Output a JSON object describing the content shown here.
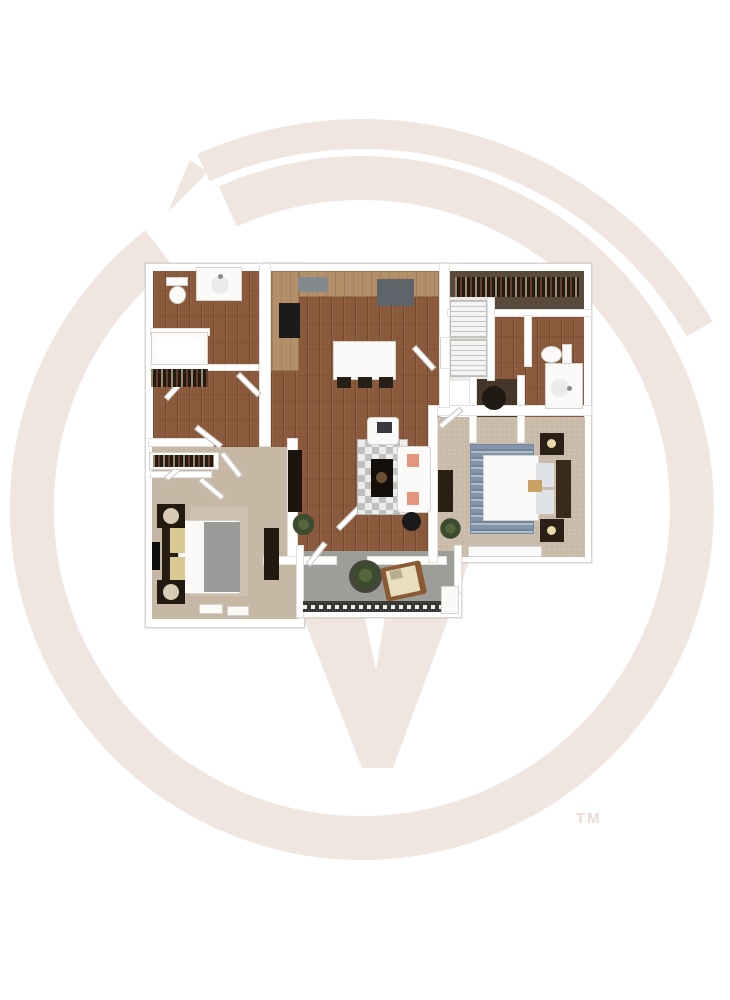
{
  "watermark": {
    "symbol": "V",
    "trademark_label": "TM",
    "color": "#f1e6df"
  },
  "plan": {
    "wall_color": "#ffffff",
    "wood_color": "#8b5a3c",
    "carpet_color": "#c9baa9",
    "patio_color": "#9d9d99",
    "rooms": [
      "bathroom-1",
      "hallway",
      "bedroom-left",
      "closet-left",
      "kitchen",
      "living-room",
      "walk-in-closet",
      "laundry-closet",
      "bathroom-2",
      "bedroom-right",
      "patio"
    ],
    "elements": [
      {
        "n": "slab-left-wing",
        "cls": "slab",
        "x": 145,
        "y": 263,
        "w": 160,
        "h": 365
      },
      {
        "n": "slab-center",
        "cls": "slab",
        "x": 263,
        "y": 263,
        "w": 184,
        "h": 302
      },
      {
        "n": "slab-right-wing",
        "cls": "slab",
        "x": 440,
        "y": 263,
        "w": 152,
        "h": 300
      },
      {
        "n": "slab-patio",
        "cls": "slab",
        "x": 296,
        "y": 545,
        "w": 166,
        "h": 73
      },
      {
        "n": "floor-bathroom1-hall",
        "cls": "wood",
        "x": 153,
        "y": 271,
        "w": 106,
        "h": 176
      },
      {
        "n": "floor-kitchen-living",
        "cls": "wood",
        "x": 271,
        "y": 271,
        "w": 168,
        "h": 287
      },
      {
        "n": "floor-walkin-closet",
        "x": 449,
        "y": 271,
        "w": 135,
        "h": 42,
        "c": "#5a4a3c"
      },
      {
        "n": "floor-laundry",
        "x": 449,
        "y": 297,
        "w": 40,
        "h": 84,
        "c": "#eceae7"
      },
      {
        "n": "floor-bathroom2",
        "cls": "wood",
        "x": 489,
        "y": 315,
        "w": 95,
        "h": 126
      },
      {
        "n": "floor-utility-nook",
        "x": 477,
        "y": 379,
        "w": 40,
        "h": 62,
        "c": "#443629"
      },
      {
        "n": "floor-bedroom-right",
        "cls": "carpet",
        "x": 437,
        "y": 417,
        "w": 148,
        "h": 140
      },
      {
        "n": "floor-bedroom-left",
        "cls": "carpet",
        "x": 152,
        "y": 447,
        "w": 146,
        "h": 172,
        "c": "#c7b7a5"
      },
      {
        "n": "floor-patio",
        "cls": "concrete",
        "x": 304,
        "y": 551,
        "w": 150,
        "h": 61,
        "c": "#9d9d99"
      },
      {
        "n": "wall-bath1-kitchen",
        "cls": "wall",
        "x": 259,
        "y": 263,
        "w": 12,
        "h": 184
      },
      {
        "n": "wall-tub",
        "cls": "wall",
        "x": 150,
        "y": 328,
        "w": 60,
        "h": 8
      },
      {
        "n": "wall-closet-left",
        "cls": "wall",
        "x": 150,
        "y": 364,
        "w": 109,
        "h": 7
      },
      {
        "n": "wall-hall-bedroom-left",
        "cls": "wall",
        "x": 148,
        "y": 438,
        "w": 66,
        "h": 9
      },
      {
        "n": "wall-bedleft-living",
        "cls": "wall",
        "x": 287,
        "y": 438,
        "w": 11,
        "h": 125
      },
      {
        "n": "wall-living-south-a",
        "cls": "wall",
        "x": 263,
        "y": 556,
        "w": 74,
        "h": 9
      },
      {
        "n": "wall-living-south-b",
        "cls": "wall",
        "x": 367,
        "y": 556,
        "w": 80,
        "h": 9
      },
      {
        "n": "wall-kitchen-closet",
        "cls": "wall",
        "x": 439,
        "y": 263,
        "w": 11,
        "h": 75
      },
      {
        "n": "wall-closet-bottom",
        "cls": "wall",
        "x": 447,
        "y": 309,
        "w": 145,
        "h": 8
      },
      {
        "n": "wall-laundry-right",
        "cls": "wall",
        "x": 487,
        "y": 297,
        "w": 8,
        "h": 84
      },
      {
        "n": "wall-nook-left",
        "cls": "wall",
        "x": 469,
        "y": 375,
        "w": 8,
        "h": 68
      },
      {
        "n": "wall-nook-right",
        "cls": "wall",
        "x": 517,
        "y": 375,
        "w": 8,
        "h": 68
      },
      {
        "n": "wall-bath2-bedroom",
        "cls": "wall",
        "x": 437,
        "y": 405,
        "w": 155,
        "h": 11
      },
      {
        "n": "wall-living-bedright",
        "cls": "wall",
        "x": 428,
        "y": 405,
        "w": 10,
        "h": 158
      },
      {
        "n": "wall-bath2-inner",
        "cls": "wall",
        "x": 524,
        "y": 315,
        "w": 8,
        "h": 52
      },
      {
        "n": "wall-patio-left",
        "cls": "wall",
        "x": 296,
        "y": 545,
        "w": 8,
        "h": 73
      },
      {
        "n": "wall-patio-right",
        "cls": "wall",
        "x": 454,
        "y": 545,
        "w": 8,
        "h": 48
      },
      {
        "n": "wall-bedleft-closet",
        "cls": "wall",
        "x": 150,
        "y": 471,
        "w": 62,
        "h": 7
      },
      {
        "n": "wall-kitchen-hall-south",
        "cls": "wall",
        "x": 439,
        "y": 368,
        "w": 11,
        "h": 40
      },
      {
        "n": "door-bathroom1",
        "cls": "door",
        "x": 238,
        "y": 371,
        "w": 30,
        "h": 6,
        "rot": 45
      },
      {
        "n": "door-hall-a",
        "cls": "door",
        "x": 166,
        "y": 396,
        "w": 32,
        "h": 6,
        "rot": -48
      },
      {
        "n": "door-hall-b",
        "cls": "door",
        "x": 196,
        "y": 424,
        "w": 32,
        "h": 6,
        "rot": 38
      },
      {
        "n": "door-bedleft-closet-a",
        "cls": "door",
        "x": 166,
        "y": 476,
        "w": 30,
        "h": 6,
        "rot": -40
      },
      {
        "n": "door-bedleft-closet-b",
        "cls": "door",
        "x": 200,
        "y": 476,
        "w": 30,
        "h": 6,
        "rot": 40
      },
      {
        "n": "door-bedleft-entry",
        "cls": "door",
        "x": 222,
        "y": 450,
        "w": 30,
        "h": 6,
        "rot": 52
      },
      {
        "n": "door-kitchen-side",
        "cls": "door",
        "x": 414,
        "y": 344,
        "w": 30,
        "h": 6,
        "rot": 48
      },
      {
        "n": "door-hall2",
        "cls": "door",
        "x": 452,
        "y": 318,
        "w": 26,
        "h": 6,
        "rot": -44
      },
      {
        "n": "door-bathroom2",
        "cls": "door",
        "x": 558,
        "y": 398,
        "w": 24,
        "h": 6,
        "rot": -45
      },
      {
        "n": "door-living-patio",
        "cls": "door",
        "x": 338,
        "y": 526,
        "w": 30,
        "h": 6,
        "rot": -45
      },
      {
        "n": "door-patio-entry",
        "cls": "door",
        "x": 308,
        "y": 562,
        "w": 28,
        "h": 6,
        "rot": -52
      },
      {
        "n": "door-bedright-entry",
        "cls": "door",
        "x": 440,
        "y": 424,
        "w": 28,
        "h": 6,
        "rot": -40
      },
      {
        "n": "toilet1-tank",
        "cls": "white",
        "x": 166,
        "y": 277,
        "w": 22,
        "h": 9
      },
      {
        "n": "toilet1-bowl",
        "cls": "white",
        "x": 169,
        "y": 286,
        "w": 17,
        "h": 18,
        "br": "50%"
      },
      {
        "n": "vanity1",
        "cls": "white",
        "x": 196,
        "y": 267,
        "w": 46,
        "h": 34
      },
      {
        "n": "sink1",
        "x": 211,
        "y": 276,
        "w": 18,
        "h": 18,
        "c": "#ebebe9",
        "br": "50%"
      },
      {
        "n": "faucet1",
        "x": 218,
        "y": 274,
        "w": 5,
        "h": 5,
        "c": "#8d8d8b",
        "br": "50%"
      },
      {
        "n": "bathtub",
        "cls": "white",
        "x": 151,
        "y": 332,
        "w": 57,
        "h": 33
      },
      {
        "n": "bathtub-basin",
        "x": 156,
        "y": 337,
        "w": 47,
        "h": 23,
        "c": "#ffffff",
        "br": "6px"
      },
      {
        "n": "closet-left-clothes",
        "cls": "clothes",
        "x": 151,
        "y": 369,
        "w": 57,
        "h": 18
      },
      {
        "n": "kitchen-counter-top",
        "cls": "counter",
        "x": 271,
        "y": 271,
        "w": 168,
        "h": 26
      },
      {
        "n": "kitchen-counter-left",
        "cls": "counter",
        "x": 271,
        "y": 271,
        "w": 28,
        "h": 100
      },
      {
        "n": "kitchen-sink",
        "x": 298,
        "y": 277,
        "w": 30,
        "h": 15,
        "c": "#84898e",
        "br": "2px"
      },
      {
        "n": "range",
        "x": 279,
        "y": 303,
        "w": 21,
        "h": 35,
        "c": "#1b1b1b"
      },
      {
        "n": "refrigerator",
        "x": 377,
        "y": 279,
        "w": 37,
        "h": 27,
        "c": "#5f646a"
      },
      {
        "n": "kitchen-island",
        "cls": "white",
        "x": 333,
        "y": 341,
        "w": 63,
        "h": 39
      },
      {
        "n": "barstool-1",
        "x": 337,
        "y": 377,
        "w": 14,
        "h": 11,
        "c": "#262019"
      },
      {
        "n": "barstool-2",
        "x": 358,
        "y": 377,
        "w": 14,
        "h": 11,
        "c": "#262019"
      },
      {
        "n": "barstool-3",
        "x": 379,
        "y": 377,
        "w": 14,
        "h": 11,
        "c": "#262019"
      },
      {
        "n": "walkin-closet-clothes",
        "cls": "clothes",
        "x": 455,
        "y": 277,
        "w": 124,
        "h": 20
      },
      {
        "n": "washer",
        "cls": "appliance",
        "x": 450,
        "y": 300,
        "w": 37,
        "h": 38
      },
      {
        "n": "dryer",
        "cls": "appliance",
        "x": 450,
        "y": 339,
        "w": 37,
        "h": 38
      },
      {
        "n": "toilet2-tank",
        "cls": "white",
        "x": 562,
        "y": 344,
        "w": 10,
        "h": 20
      },
      {
        "n": "toilet2-bowl",
        "cls": "white",
        "x": 541,
        "y": 346,
        "w": 21,
        "h": 17,
        "br": "50%"
      },
      {
        "n": "vanity2",
        "cls": "white",
        "x": 545,
        "y": 363,
        "w": 38,
        "h": 46
      },
      {
        "n": "sink2",
        "x": 551,
        "y": 379,
        "w": 18,
        "h": 18,
        "c": "#ebebe9",
        "br": "50%"
      },
      {
        "n": "faucet2",
        "x": 567,
        "y": 386,
        "w": 5,
        "h": 5,
        "c": "#8d8d8b",
        "br": "50%"
      },
      {
        "n": "utility-table",
        "x": 482,
        "y": 386,
        "w": 24,
        "h": 24,
        "c": "#201a15",
        "br": "50%"
      },
      {
        "n": "rug-blue",
        "cls": "bluerug",
        "x": 470,
        "y": 444,
        "w": 64,
        "h": 90
      },
      {
        "n": "bed-right",
        "cls": "white",
        "x": 483,
        "y": 455,
        "w": 56,
        "h": 66
      },
      {
        "n": "bed-right-pillow-a",
        "x": 536,
        "y": 463,
        "w": 18,
        "h": 24,
        "c": "#dfe3e7"
      },
      {
        "n": "bed-right-pillow-b",
        "x": 536,
        "y": 490,
        "w": 18,
        "h": 24,
        "c": "#dfe3e7"
      },
      {
        "n": "headboard-right",
        "x": 556,
        "y": 460,
        "w": 15,
        "h": 58,
        "c": "#3a2a1c"
      },
      {
        "n": "bed-right-throw",
        "x": 528,
        "y": 480,
        "w": 14,
        "h": 12,
        "c": "#c9a263"
      },
      {
        "n": "nightstand-right-a",
        "x": 540,
        "y": 433,
        "w": 24,
        "h": 22,
        "c": "#2a2016"
      },
      {
        "n": "lamp-right-a",
        "x": 547,
        "y": 439,
        "w": 9,
        "h": 9,
        "c": "#e9daa9",
        "br": "50%"
      },
      {
        "n": "nightstand-right-b",
        "x": 540,
        "y": 519,
        "w": 24,
        "h": 23,
        "c": "#2a2016"
      },
      {
        "n": "lamp-right-b",
        "x": 547,
        "y": 526,
        "w": 9,
        "h": 9,
        "c": "#e9daa9",
        "br": "50%"
      },
      {
        "n": "dresser-right",
        "x": 438,
        "y": 470,
        "w": 15,
        "h": 42,
        "c": "#2a2016"
      },
      {
        "n": "plant-bedroom-right",
        "cls": "plant",
        "x": 440,
        "y": 518,
        "w": 21,
        "h": 21
      },
      {
        "n": "window-bedroom-right",
        "cls": "white",
        "x": 468,
        "y": 546,
        "w": 74,
        "h": 11
      },
      {
        "n": "media-console",
        "x": 288,
        "y": 450,
        "w": 14,
        "h": 62,
        "c": "#1c140e"
      },
      {
        "n": "rug-checker",
        "cls": "checker",
        "x": 357,
        "y": 439,
        "w": 51,
        "h": 76
      },
      {
        "n": "armchair",
        "cls": "white",
        "x": 367,
        "y": 417,
        "w": 32,
        "h": 28,
        "br": "4px"
      },
      {
        "n": "armchair-pillow",
        "x": 377,
        "y": 422,
        "w": 15,
        "h": 11,
        "c": "#3a3a3e"
      },
      {
        "n": "coffee-table",
        "x": 371,
        "y": 459,
        "w": 22,
        "h": 38,
        "c": "#140f0b"
      },
      {
        "n": "table-decor",
        "x": 376,
        "y": 472,
        "w": 11,
        "h": 11,
        "c": "#6b5034",
        "br": "50%"
      },
      {
        "n": "sofa",
        "cls": "white",
        "x": 397,
        "y": 446,
        "w": 34,
        "h": 67,
        "br": "4px"
      },
      {
        "n": "sofa-pillow-a",
        "x": 407,
        "y": 454,
        "w": 12,
        "h": 13,
        "c": "#e5947e"
      },
      {
        "n": "sofa-pillow-b",
        "x": 407,
        "y": 492,
        "w": 12,
        "h": 13,
        "c": "#e5947e"
      },
      {
        "n": "side-table",
        "x": 402,
        "y": 512,
        "w": 19,
        "h": 19,
        "c": "#1a1a1a",
        "br": "50%"
      },
      {
        "n": "plant-living",
        "cls": "plant",
        "x": 292,
        "y": 514,
        "w": 23,
        "h": 21
      },
      {
        "n": "patio-planter",
        "x": 349,
        "y": 560,
        "w": 33,
        "h": 33,
        "c": "#45453e",
        "br": "50%"
      },
      {
        "n": "patio-plant",
        "cls": "plant",
        "x": 352,
        "y": 562,
        "w": 27,
        "h": 27
      },
      {
        "n": "lounge-chair",
        "x": 383,
        "y": 564,
        "w": 41,
        "h": 34,
        "c": "#8a5a34",
        "rot": -12,
        "br": "3px"
      },
      {
        "n": "lounge-cushion",
        "x": 388,
        "y": 568,
        "w": 30,
        "h": 26,
        "c": "#e9dfbe",
        "rot": -12
      },
      {
        "n": "lounge-pillow",
        "x": 390,
        "y": 570,
        "w": 12,
        "h": 9,
        "c": "#b7ad8d",
        "rot": -12
      },
      {
        "n": "patio-railing",
        "cls": "railing",
        "x": 303,
        "y": 601,
        "w": 141,
        "h": 11
      },
      {
        "n": "patio-post",
        "cls": "white",
        "x": 441,
        "y": 586,
        "w": 18,
        "h": 28
      },
      {
        "n": "closet-shelf-left",
        "cls": "white",
        "x": 149,
        "y": 452,
        "w": 70,
        "h": 18
      },
      {
        "n": "closet-left-clothes-rack",
        "cls": "clothes",
        "x": 153,
        "y": 455,
        "w": 61,
        "h": 12
      },
      {
        "n": "rug-bedroom-left",
        "x": 190,
        "y": 506,
        "w": 58,
        "h": 90,
        "c": "#cfc1b0"
      },
      {
        "n": "headboard-left",
        "x": 162,
        "y": 518,
        "w": 16,
        "h": 76,
        "c": "#281d12"
      },
      {
        "n": "bed-left",
        "cls": "white",
        "x": 178,
        "y": 520,
        "w": 62,
        "h": 74
      },
      {
        "n": "duvet-left",
        "x": 204,
        "y": 522,
        "w": 36,
        "h": 70,
        "c": "#9b9b99"
      },
      {
        "n": "bed-left-pillow-a",
        "x": 170,
        "y": 527,
        "w": 15,
        "h": 26,
        "c": "#d9ca94"
      },
      {
        "n": "bed-left-pillow-b",
        "x": 170,
        "y": 557,
        "w": 15,
        "h": 26,
        "c": "#d9ca94"
      },
      {
        "n": "nightstand-left-a",
        "x": 157,
        "y": 504,
        "w": 28,
        "h": 24,
        "c": "#221a11"
      },
      {
        "n": "lamp-left-a",
        "x": 163,
        "y": 508,
        "w": 16,
        "h": 16,
        "c": "#d8cdb4",
        "br": "50%"
      },
      {
        "n": "nightstand-left-b",
        "x": 157,
        "y": 580,
        "w": 28,
        "h": 24,
        "c": "#221a11"
      },
      {
        "n": "lamp-left-b",
        "x": 163,
        "y": 584,
        "w": 16,
        "h": 16,
        "c": "#d8cdb4",
        "br": "50%"
      },
      {
        "n": "dresser-left",
        "x": 264,
        "y": 528,
        "w": 15,
        "h": 52,
        "c": "#221a11"
      },
      {
        "n": "tv-bedroom-left",
        "x": 152,
        "y": 542,
        "w": 8,
        "h": 28,
        "c": "#0e0e0e"
      },
      {
        "n": "window-bedroom-left-a",
        "cls": "white",
        "x": 199,
        "y": 604,
        "w": 24,
        "h": 10
      },
      {
        "n": "window-bedroom-left-b",
        "cls": "white",
        "x": 227,
        "y": 606,
        "w": 22,
        "h": 10
      }
    ]
  }
}
